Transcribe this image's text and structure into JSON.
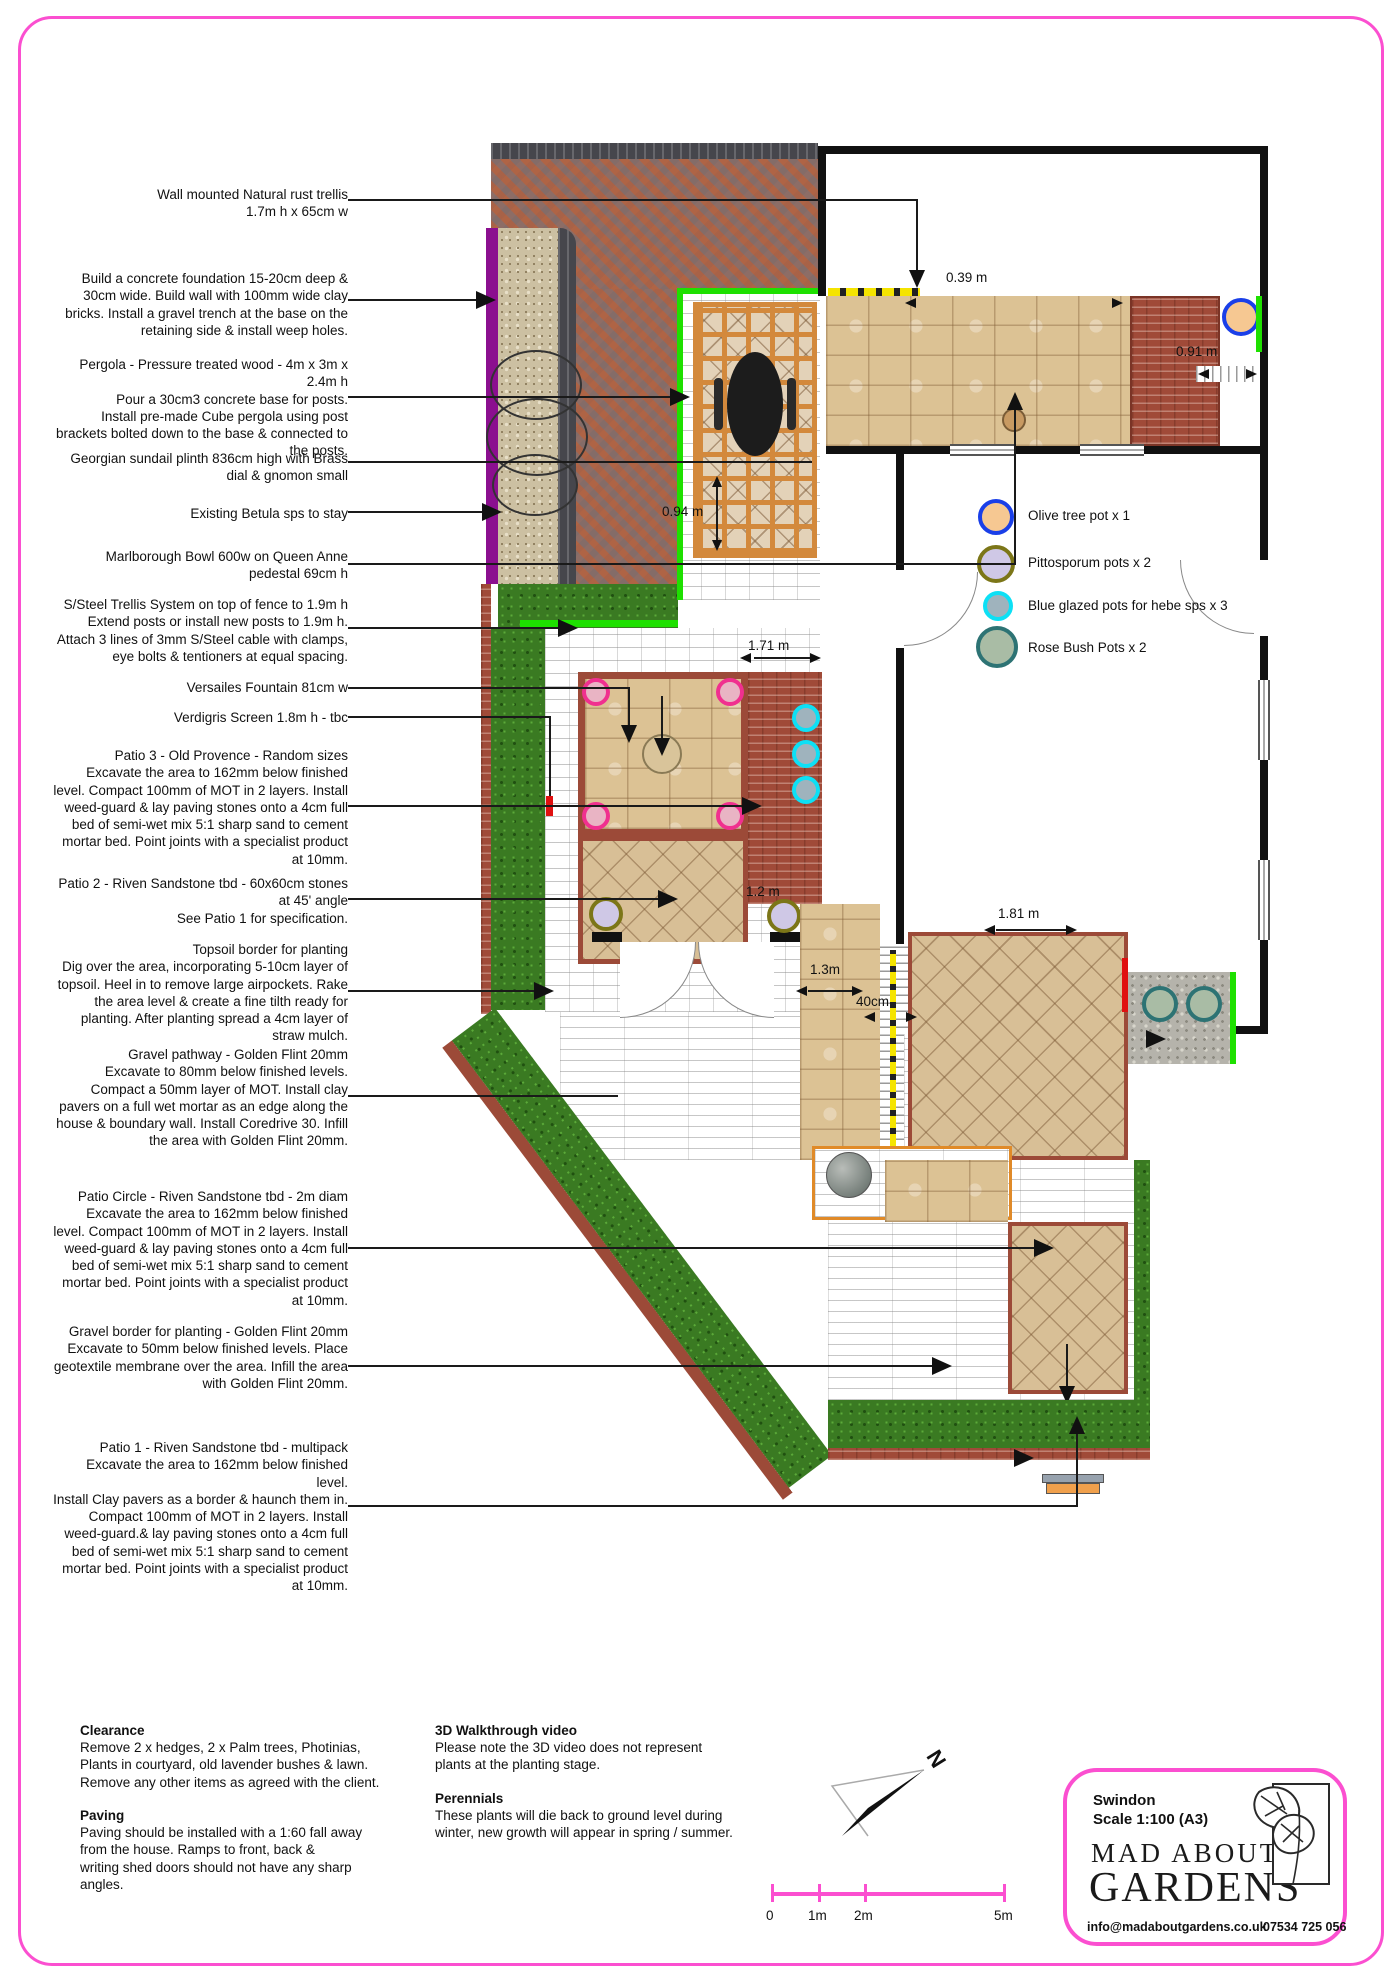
{
  "colors": {
    "accent_pink": "#fb4fd0",
    "highlight_green": "#1ee000",
    "highlight_yellow": "#f5e400",
    "purple_wall": "#8b0f8f"
  },
  "annotations": [
    {
      "text": "Wall mounted Natural rust trellis\n1.7m  h x 65cm w"
    },
    {
      "text": "Build a concrete foundation 15-20cm deep & 30cm wide. Build wall with 100mm wide clay bricks. Install a gravel trench at the base on the retaining side & install weep holes."
    },
    {
      "text": "Pergola - Pressure treated wood - 4m x 3m x 2.4m h\nPour a 30cm3 concrete base for posts.\nInstall pre-made Cube pergola using post brackets bolted down to the base & connected to the posts."
    },
    {
      "text": "Georgian sundail plinth 836cm high with Brass dial & gnomon small"
    },
    {
      "text": "Existing  Betula  sps to stay"
    },
    {
      "text": "Marlborough Bowl 600w on Queen Anne pedestal 69cm h"
    },
    {
      "text": "S/Steel Trellis System on top of fence to 1.9m h\nExtend posts or install new posts to 1.9m h.\nAttach 3 lines of 3mm S/Steel cable with clamps, eye bolts & tentioners at equal spacing."
    },
    {
      "text": "Versailes Fountain 81cm w"
    },
    {
      "text": "Verdigris Screen 1.8m h - tbc"
    },
    {
      "text": "Patio 3 - Old Provence - Random sizes\nExcavate the area to 162mm below finished level. Compact 100mm of MOT in 2 layers. Install weed-guard & lay paving stones onto a 4cm full bed of semi-wet mix 5:1 sharp sand to cement mortar bed. Point joints with a specialist product at 10mm."
    },
    {
      "text": "Patio 2 - Riven Sandstone tbd - 60x60cm stones at 45' angle\nSee Patio 1 for specification."
    },
    {
      "text": "Topsoil border for planting\nDig over the area, incorporating  5-10cm layer of topsoil. Heel in to remove large airpockets. Rake the area level & create a fine tilth ready for planting. After planting spread a 4cm layer of straw mulch."
    },
    {
      "text": "Gravel pathway - Golden Flint 20mm\nExcavate to 80mm below finished levels. Compact a 50mm layer of MOT. Install clay pavers on a full wet mortar as an edge along the house & boundary wall. Install Coredrive 30. Infill the area with Golden Flint 20mm."
    },
    {
      "text": "Patio Circle - Riven Sandstone tbd - 2m diam\nExcavate the area to 162mm below finished level. Compact 100mm of MOT in 2 layers. Install weed-guard & lay paving stones onto a 4cm full bed of semi-wet mix 5:1 sharp sand to cement mortar bed. Point joints with a specialist product at 10mm."
    },
    {
      "text": "Gravel border for planting - Golden Flint 20mm\nExcavate to 50mm below finished levels. Place geotextile membrane over the area. Infill the area with Golden Flint 20mm."
    },
    {
      "text": "Patio 1 - Riven Sandstone tbd - multipack\nExcavate the area to 162mm below finished level.\nInstall Clay pavers as a border & haunch them in. Compact 100mm of MOT in 2 layers. Install weed-guard.& lay paving stones onto a 4cm full bed of semi-wet mix 5:1 sharp sand to cement mortar bed. Point joints with a specialist product at 10mm."
    }
  ],
  "notes": {
    "clearance": {
      "title": "Clearance",
      "body": "Remove 2 x hedges, 2 x Palm trees, Photinias,\nPlants in courtyard, old lavender bushes & lawn.\nRemove any other items as agreed with the client."
    },
    "paving": {
      "title": "Paving",
      "body": "Paving should be installed with a 1:60 fall away\nfrom the house. Ramps to front, back &\nwriting shed doors should not have any sharp\nangles."
    },
    "walkthrough": {
      "title": "3D Walkthrough video",
      "body": "Please note the 3D video does not represent\nplants at the planting stage."
    },
    "perennials": {
      "title": "Perennials",
      "body": "These plants will die back to ground level during\nwinter, new growth will appear in spring / summer."
    }
  },
  "legend": {
    "items": [
      {
        "label": "Olive tree pot x 1",
        "fill": "#f6c892",
        "ring": "#1a3fe8"
      },
      {
        "label": "Pittosporum pots x 2",
        "fill": "#cfc8e6",
        "ring": "#7c7618"
      },
      {
        "label": "Blue glazed pots for hebe sps x 3",
        "fill": "#9fb3bd",
        "ring": "#0de0f5"
      },
      {
        "label": "Rose Bush Pots x 2",
        "fill": "#a9bca5",
        "ring": "#2d7374"
      }
    ]
  },
  "plan_markers": {
    "fountain_pots": {
      "fill": "#e9b4c4",
      "ring": "#f0308f"
    },
    "hebe_pots": {
      "fill": "#9fb3bd",
      "ring": "#0de0f5"
    },
    "pittosporum_pots": {
      "fill": "#cfc8e6",
      "ring": "#7c7618"
    },
    "rose_pots": {
      "fill": "#a9bca5",
      "ring": "#2d7374"
    },
    "olive_pot": {
      "fill": "#f6c892",
      "ring": "#1a3fe8"
    },
    "red_accent": "#e01010"
  },
  "dims": {
    "d039": "0.39 m",
    "d091": "0.91 m",
    "d094": "0.94 m",
    "d171": "1.71 m",
    "d12": "1.2 m",
    "d13": "1.3m",
    "d40": "40cm",
    "d181": "1.81 m"
  },
  "scalebar": {
    "labels": [
      "0",
      "1m",
      "2m",
      "5m"
    ]
  },
  "north": {
    "label": "N"
  },
  "titleblock": {
    "location": "Swindon",
    "scale": "Scale 1:100 (A3)",
    "brand_line1": "MAD ABOUT",
    "brand_line2": "GARDENS",
    "email": "info@madaboutgardens.co.uk",
    "phone": "07534 725 056"
  }
}
